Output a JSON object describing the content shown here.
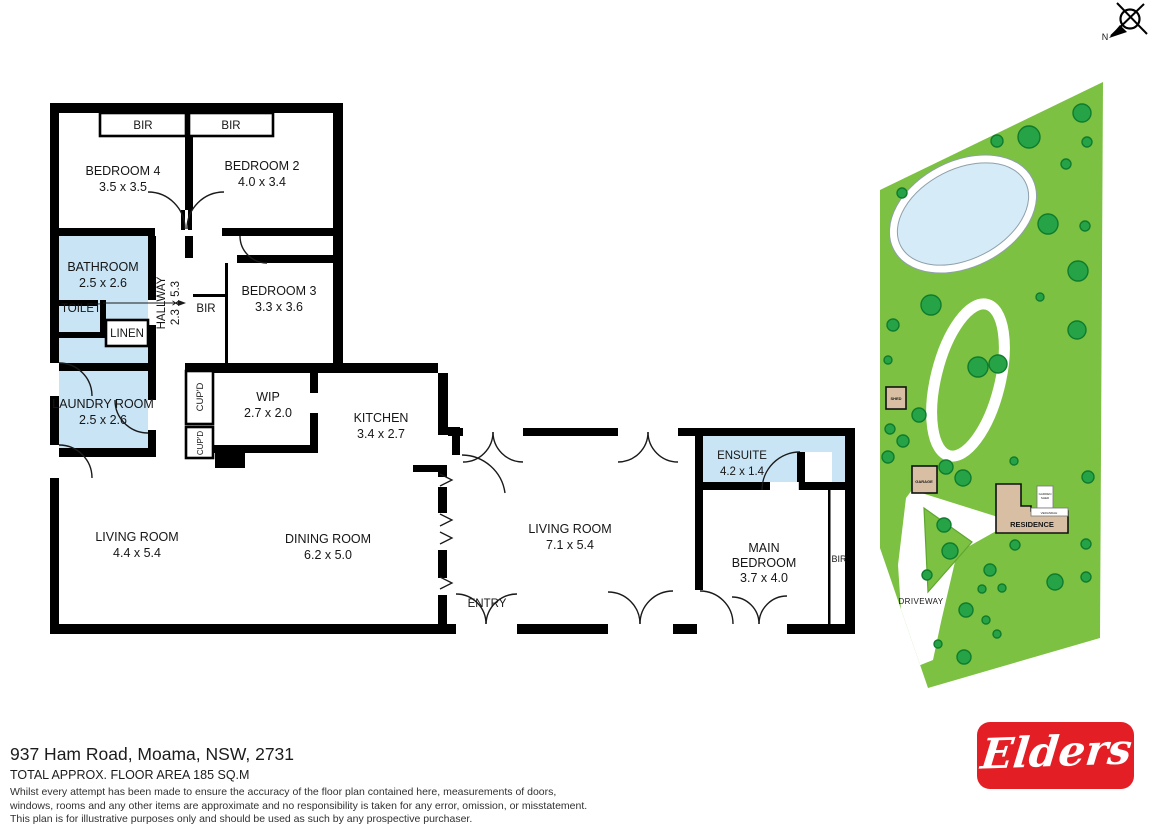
{
  "rooms": {
    "bir_top_left": {
      "label": "BIR"
    },
    "bir_top_right": {
      "label": "BIR"
    },
    "bedroom4": {
      "name": "BEDROOM 4",
      "dims": "3.5 x 3.5"
    },
    "bedroom2": {
      "name": "BEDROOM 2",
      "dims": "4.0 x 3.4"
    },
    "bathroom": {
      "name": "BATHROOM",
      "dims": "2.5 x 2.6"
    },
    "toilet": {
      "name": "TOILET"
    },
    "hallway": {
      "name": "HALLWAY",
      "dims": "2.3 x 5.3"
    },
    "linen": {
      "name": "LINEN"
    },
    "bir_hallway": {
      "label": "BIR"
    },
    "bedroom3": {
      "name": "BEDROOM 3",
      "dims": "3.3 x 3.6"
    },
    "laundry": {
      "name": "LAUNDRY ROOM",
      "dims": "2.5 x 2.6"
    },
    "cupboard1": {
      "label": "CUP'D"
    },
    "cupboard2": {
      "label": "CUP'D"
    },
    "wip": {
      "name": "WIP",
      "dims": "2.7 x 2.0"
    },
    "kitchen": {
      "name": "KITCHEN",
      "dims": "3.4 x 2.7"
    },
    "living1": {
      "name": "LIVING ROOM",
      "dims": "4.4 x 5.4"
    },
    "dining": {
      "name": "DINING ROOM",
      "dims": "6.2 x 5.0"
    },
    "living2": {
      "name": "LIVING ROOM",
      "dims": "7.1 x 5.4"
    },
    "entry": {
      "name": "ENTRY"
    },
    "ensuite": {
      "name": "ENSUITE",
      "dims": "4.2 x 1.4"
    },
    "main_bedroom": {
      "name_line1": "MAIN",
      "name_line2": "BEDROOM",
      "dims": "3.7 x 4.0"
    },
    "bir_main_bedroom": {
      "label": "BIR"
    }
  },
  "site": {
    "shed": "SHED",
    "garage": "GARAGE",
    "residence": "RESIDENCE",
    "driveway": "DRIVEWAY",
    "small_structure_line1": "GARDEN",
    "small_structure_line2": "SHED",
    "veranda": "VERANDAH"
  },
  "compass": {
    "north": "N"
  },
  "footer": {
    "address": "937 Ham Road, Moama, NSW, 2731",
    "floor_area": "TOTAL APPROX. FLOOR AREA 185 SQ.M",
    "disclaimer_line1": "Whilst every attempt has been made to ensure the accuracy of the floor plan contained here, measurements of doors,",
    "disclaimer_line2": "windows, rooms and any other items are approximate and no responsibility is taken for any error, omission, or misstatement.",
    "disclaimer_line3": "This plan is for illustrative purposes only and should be used as such by any prospective purchaser."
  },
  "logo": {
    "brand": "Elders"
  },
  "colors": {
    "wall": "#000000",
    "wet_area": "#C8E4F5",
    "grass": "#7CC142",
    "tree_fill": "#27A347",
    "tree_stroke": "#0F7C2D",
    "water": "#D6EBF8",
    "building_fill": "#D8BFA3",
    "logo_red": "#E31E24"
  }
}
